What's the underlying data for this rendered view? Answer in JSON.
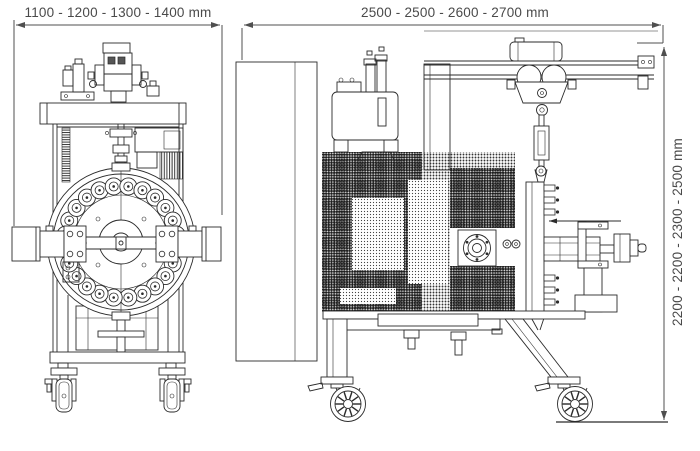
{
  "theme": {
    "background": "#ffffff",
    "line_color": "#2b2b2b",
    "dim_line_color": "#4f4f4f",
    "dim_text_color": "#4a4a4a"
  },
  "dimensions": {
    "front_width": "1100 - 1200 - 1300 - 1400 mm",
    "side_width": "2500 - 2500 - 2600 - 2700 mm",
    "side_height": "2200 - 2200 - 2300 - 2500 mm"
  }
}
